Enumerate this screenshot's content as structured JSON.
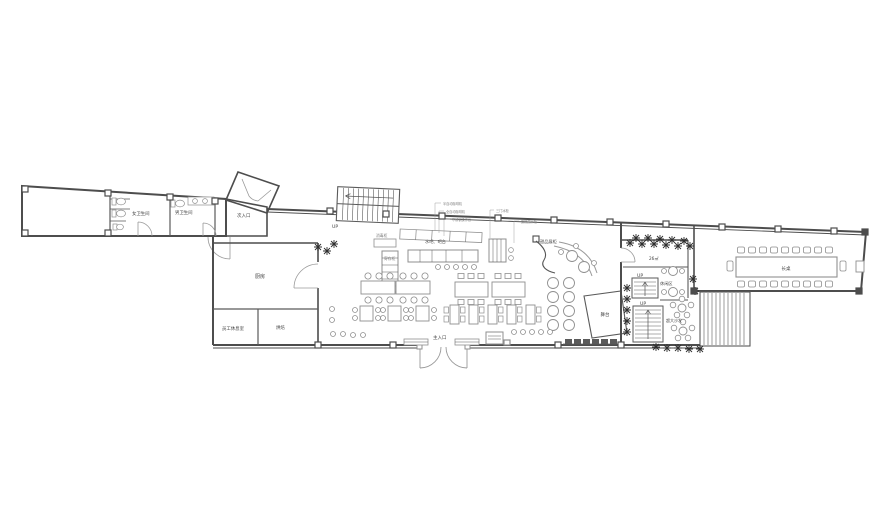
{
  "rooms": {
    "women_toilet": "女卫生间",
    "men_toilet": "男卫生间",
    "kitchen": "厨房",
    "staff_lounge": "员工休息室",
    "bakery": "烘焙",
    "lounge": "休闲区",
    "sofa_area": "超大沙发",
    "stage": "舞台",
    "long_table": "长桌",
    "area_26": "26㎡"
  },
  "entrances": {
    "main": "主入口",
    "secondary": "次入口"
  },
  "stairs": {
    "up": "UP"
  },
  "counters": {
    "bar": "水吧、吧台",
    "dessert_display": "甜品展柜",
    "locker": "寄存柜",
    "sterilizer": "消毒柜"
  },
  "equipment_annotations": [
    "半自动咖啡机",
    "全自动咖啡机",
    "不锈钢操作台",
    "三门冰柜",
    "蛋糕展示柜"
  ],
  "colors": {
    "wall": "#4d4d4d",
    "furniture": "#8f8f8f",
    "text": "#444444"
  }
}
